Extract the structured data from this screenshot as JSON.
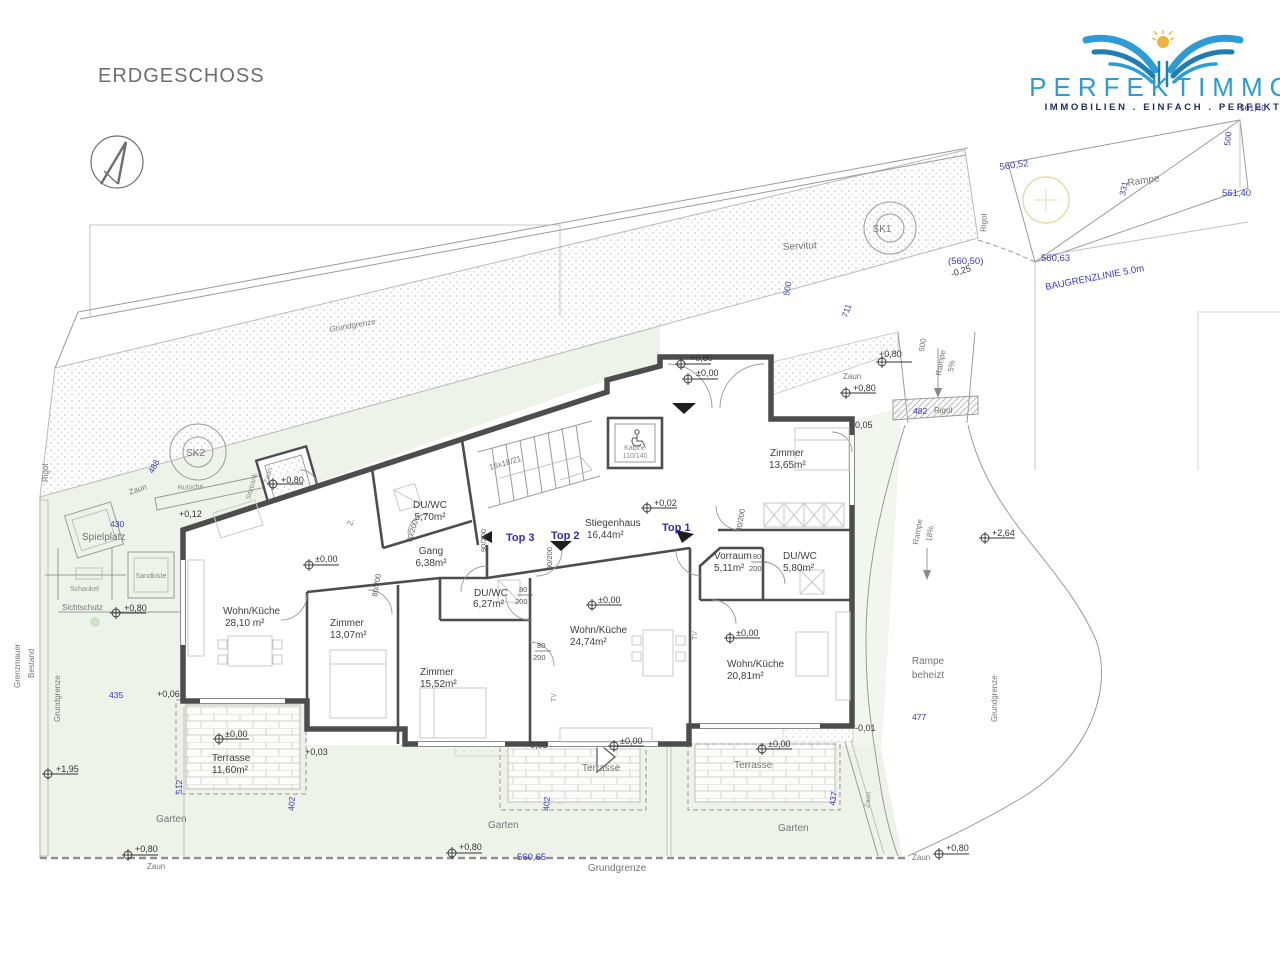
{
  "title": "ERDGESCHOSS",
  "logo": {
    "brand": "PERFEKTIMMO",
    "tagline": "IMMOBILIEN . EINFACH . PERFEKT",
    "brand_color": "#2d9bd5",
    "tagline_color": "#1c2d5c",
    "sun_color": "#f0b43c"
  },
  "tops": [
    "Top 1",
    "Top 2",
    "Top 3"
  ],
  "rooms": [
    {
      "name": "DU/WC",
      "area": "5,70m²"
    },
    {
      "name": "Gang",
      "area": "6,38m²"
    },
    {
      "name": "Stiegenhaus",
      "area": "16,44m²"
    },
    {
      "name": "Zimmer",
      "area": "13,65m²"
    },
    {
      "name": "Vorraum",
      "area": "5,11m²"
    },
    {
      "name": "DU/WC",
      "area": "5,80m²"
    },
    {
      "name": "Wohn/Küche",
      "area": "28,10 m²"
    },
    {
      "name": "Zimmer",
      "area": "13,07m²"
    },
    {
      "name": "DU/WC",
      "area": "6,27m²"
    },
    {
      "name": "Zimmer",
      "area": "15,52m²"
    },
    {
      "name": "Wohn/Küche",
      "area": "24,74m²"
    },
    {
      "name": "Wohn/Küche",
      "area": "20,81m²"
    },
    {
      "name": "Terrasse",
      "area": "11,60m²"
    }
  ],
  "t": {
    "servitut": "Servitut",
    "sk1": "SK1",
    "sk2": "SK2",
    "rigol": "Rigol",
    "rampe": "Rampe",
    "p5": "5%",
    "p18": "18%",
    "beheizt": "beheizt",
    "grundgrenze": "Grundgrenze",
    "grenzmauer": "Grenzmauer",
    "bestand": "Bestand",
    "zaun": "Zaun",
    "spielplatz": "Spielplatz",
    "schaukel": "Schaukel",
    "sandkiste": "Sandkiste",
    "rutsche": "Rutsche",
    "sitzbank": "Sitzbank",
    "sichtschutz": "Sichtschutz",
    "garten": "Garten",
    "terrasse": "Terrasse",
    "baugrenzlinie": "BAUGRENZLINIE  5.0m",
    "kabine": "Kabine",
    "kabine_size": "110/140",
    "stair_dim": "16x18/21",
    "tv": "TV",
    "two": "2."
  },
  "dim": {
    "d560_52": "560,52",
    "d561_40": "561,40",
    "d560_63": "560,63",
    "d560_50": "(560,50)",
    "d560_65": "560,65",
    "d500": "500",
    "d331": "331",
    "d711": "711",
    "d482": "482",
    "d488": "488",
    "d430": "430",
    "d435": "435",
    "d512": "512",
    "d402": "402",
    "d437": "437",
    "d477": "477"
  },
  "lvl": {
    "p080": "+0,80",
    "z000": "±0,00",
    "p002": "+0,02",
    "p012": "+0,12",
    "p006": "+0,06",
    "p195": "+1,95",
    "p003": "+0,03",
    "m003": "-0,03",
    "m005": "-0,05",
    "m001": "-0,01",
    "m025": "-0,25",
    "p264": "+2,64"
  },
  "door": {
    "d90200": "90/200",
    "d80200": "80/200",
    "d80": "80",
    "d200": "200"
  }
}
